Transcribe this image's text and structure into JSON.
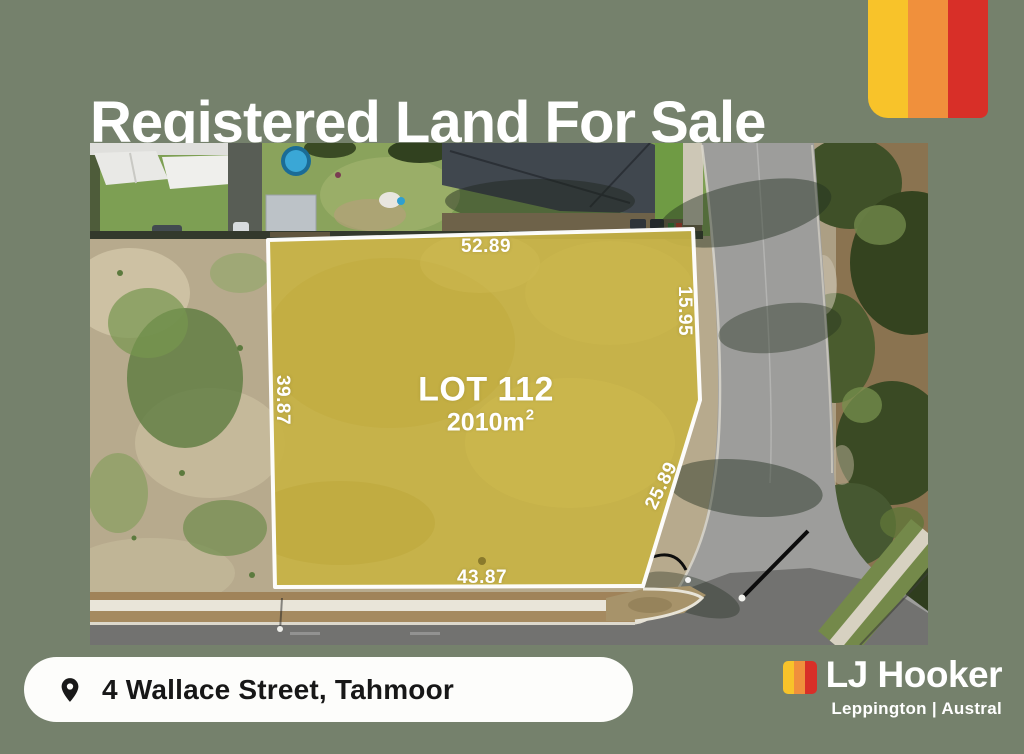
{
  "page": {
    "background_color": "#75816C"
  },
  "header": {
    "title": "Registered Land For Sale"
  },
  "corner_logo": {
    "icon": "brand-stripes-icon",
    "colors": {
      "yellow": "#F8C32A",
      "orange": "#F0903C",
      "red": "#D82F28"
    }
  },
  "aerial": {
    "lot": {
      "name": "LOT 112",
      "area": "2010m",
      "area_exponent": "2",
      "overlay_color": "#C7B246",
      "boundary_color": "#FFFFFF",
      "measurements": {
        "top": "52.89",
        "left": "39.87",
        "right_upper": "15.95",
        "right_lower": "25.89",
        "bottom": "43.87"
      }
    }
  },
  "address_bar": {
    "icon": "location-pin-icon",
    "address": "4 Wallace Street, Tahmoor"
  },
  "brand": {
    "icon": "brand-stripes-icon",
    "name": "LJ Hooker",
    "office": "Leppington | Austral",
    "colors": {
      "yellow": "#F8C32A",
      "orange": "#F0903C",
      "red": "#D82F28"
    }
  }
}
